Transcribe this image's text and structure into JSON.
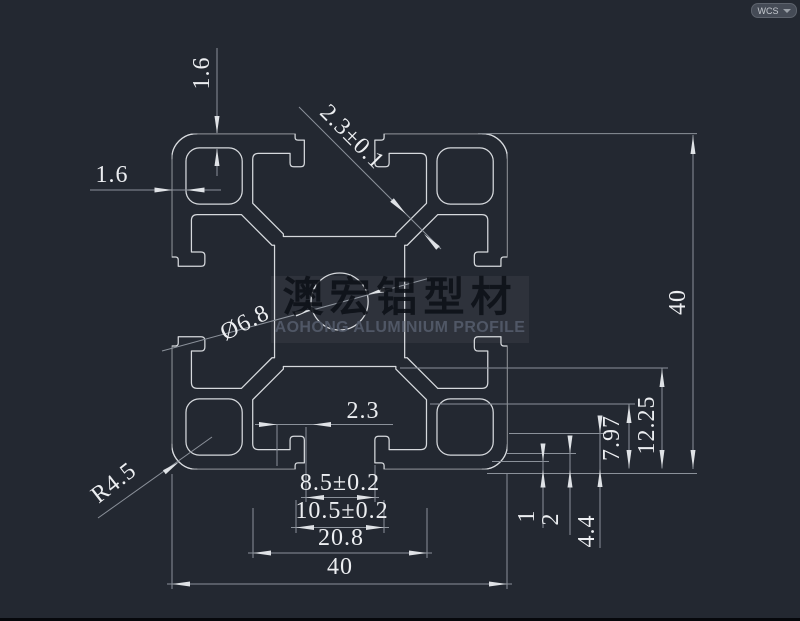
{
  "wcs_badge": {
    "label": "WCS"
  },
  "watermark": {
    "chinese": "澳宏铝型材",
    "english": "AOHONG ALUMINIUM PROFILE"
  },
  "dimensions": {
    "top_wall_thickness": "1.6",
    "left_wall_thickness": "1.6",
    "slot_lip_diagonal": "2.3±0.1",
    "center_hole_diameter": "Ø6.8",
    "corner_radius": "R4.5",
    "bottom_lip_offset": "2.3",
    "slot_opening": "8.5±0.2",
    "slot_inner_opening": "10.5±0.2",
    "slot_cavity_width": "20.8",
    "overall_width": "40",
    "overall_height": "40",
    "step_1": "1",
    "step_2": "2",
    "step_3": "4.4",
    "step_4": "7.97",
    "step_5": "12.25"
  },
  "colors": {
    "background": "#232831",
    "profile_line": "#d6d9dd",
    "dimension_line": "#8b919a",
    "text": "#eceef1"
  }
}
